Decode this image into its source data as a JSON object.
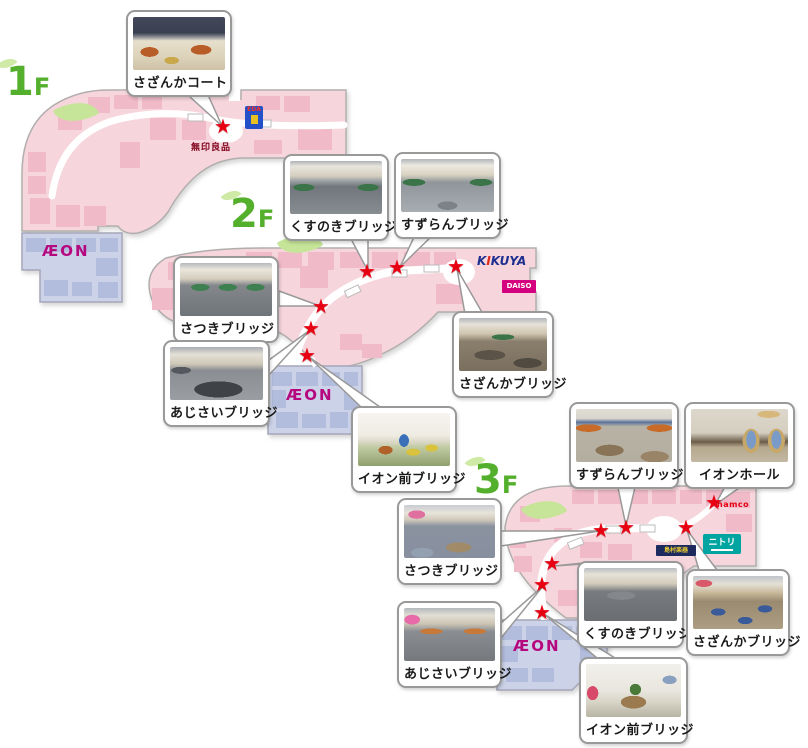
{
  "aeon_wordmark": "ÆON",
  "floors": [
    {
      "num": "1",
      "suffix": "F",
      "star_count": 1,
      "callouts": [
        {
          "label": "さざんかコート"
        }
      ],
      "store_texts": [
        {
          "name": "muji",
          "text": "無印良品"
        }
      ],
      "logos": [
        {
          "name": "blue-store-logo",
          "text": "EDA"
        }
      ]
    },
    {
      "num": "2",
      "suffix": "F",
      "star_count": 6,
      "callouts": [
        {
          "label": "くすのきブリッジ"
        },
        {
          "label": "すずらんブリッジ"
        },
        {
          "label": "さつきブリッジ"
        },
        {
          "label": "あじさいブリッジ"
        },
        {
          "label": "さざんかブリッジ"
        },
        {
          "label": "イオン前ブリッジ"
        }
      ],
      "logos": [
        {
          "name": "kikuya",
          "p1": "K",
          "p2": "I",
          "p3": "KUYA"
        },
        {
          "name": "daiso",
          "text": "DAISO"
        }
      ]
    },
    {
      "num": "3",
      "suffix": "F",
      "star_count": 7,
      "callouts": [
        {
          "label": "すずらんブリッジ"
        },
        {
          "label": "イオンホール"
        },
        {
          "label": "さつきブリッジ"
        },
        {
          "label": "くすのきブリッジ"
        },
        {
          "label": "さざんかブリッジ"
        },
        {
          "label": "あじさいブリッジ"
        },
        {
          "label": "イオン前ブリッジ"
        }
      ],
      "logos": [
        {
          "name": "nitori",
          "text": "ニトリ"
        },
        {
          "name": "shimamura",
          "text": "島村楽器"
        },
        {
          "name": "namco",
          "text": "namco"
        }
      ]
    }
  ],
  "colors": {
    "mall_pink": "#f7d5dd",
    "tenant_pink": "#f1bac9",
    "aeon_lavender": "#ccd3e8",
    "aeon_block": "#b2bcdc",
    "aeon_magenta": "#b5077e",
    "star_red": "#e60012",
    "floor_label_green": "#54b02c",
    "kikuya_blue": "#1d2f8f",
    "daiso_magenta": "#d5007f",
    "nitori_teal": "#00a4a0",
    "shimamura_navy": "#1c2a5e",
    "muji_red": "#7f0019"
  }
}
